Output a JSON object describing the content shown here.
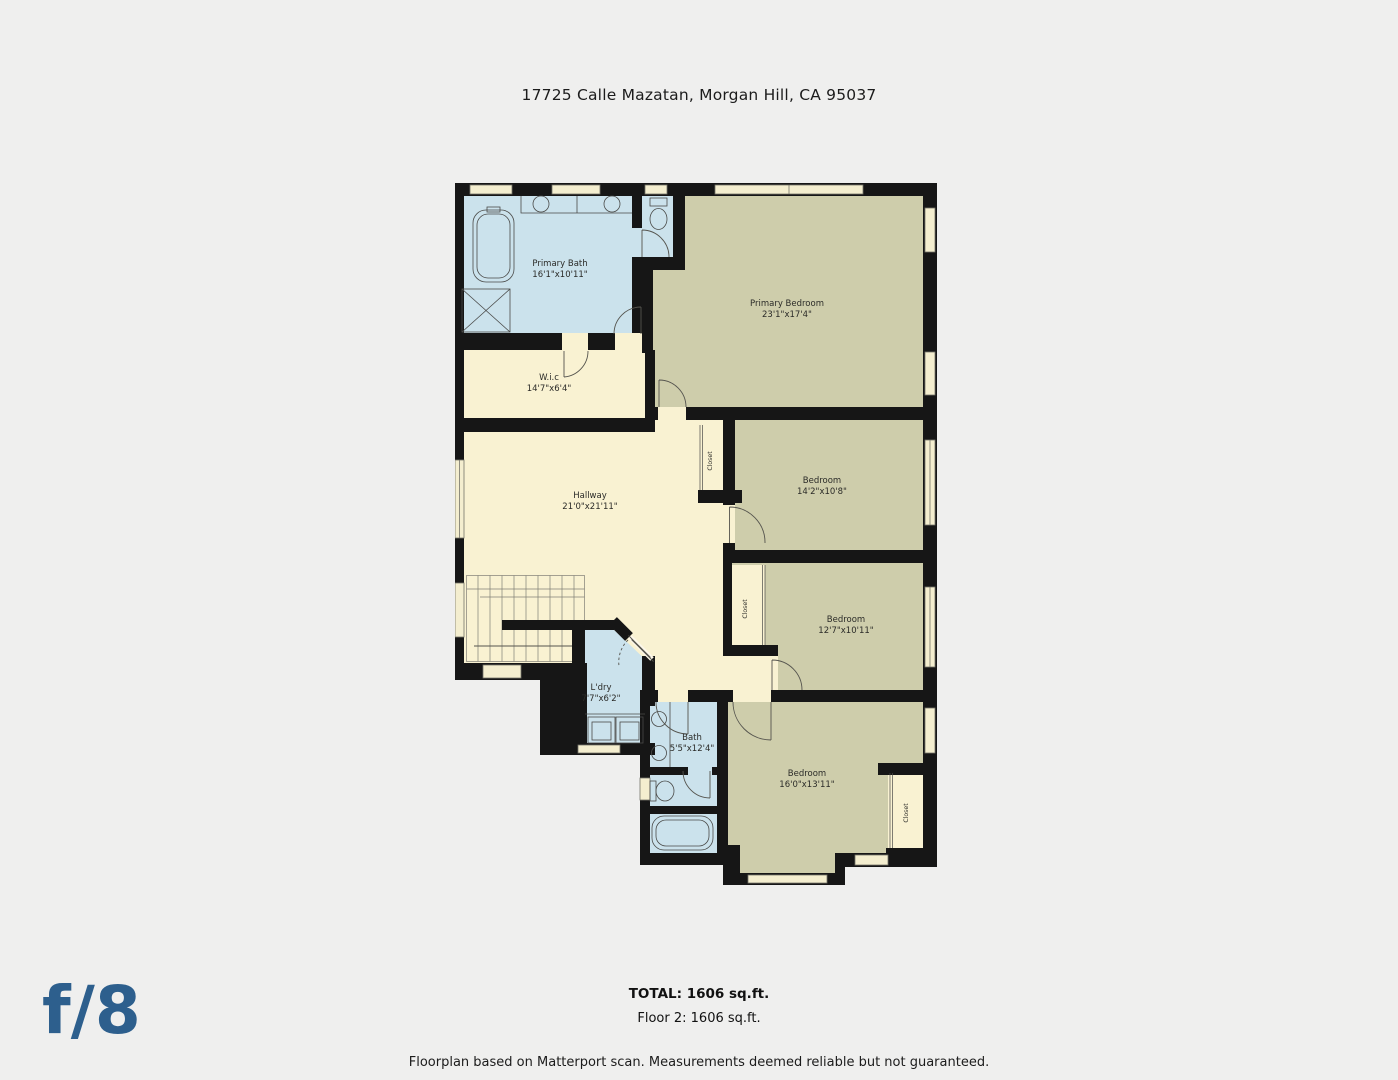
{
  "title": "17725 Calle Mazatan, Morgan Hill, CA 95037",
  "rooms": [
    {
      "name": "Primary Bath",
      "dims": "16'1\"x10'11\""
    },
    {
      "name": "Primary Bedroom",
      "dims": "23'1\"x17'4\""
    },
    {
      "name": "W.i.c",
      "dims": "14'7\"x6'4\""
    },
    {
      "name": "Hallway",
      "dims": "21'0\"x21'11\""
    },
    {
      "name": "Bedroom",
      "dims": "14'2\"x10'8\""
    },
    {
      "name": "Bedroom",
      "dims": "12'7\"x10'11\""
    },
    {
      "name": "L'dry",
      "dims": "7'7\"x6'2\""
    },
    {
      "name": "Bath",
      "dims": "5'5\"x12'4\""
    },
    {
      "name": "Bedroom",
      "dims": "16'0\"x13'11\""
    }
  ],
  "closets": [
    {
      "label": "Closet"
    },
    {
      "label": "Closet"
    },
    {
      "label": "Closet"
    }
  ],
  "summary": {
    "total": "TOTAL: 1606 sq.ft.",
    "floor": "Floor 2: 1606 sq.ft."
  },
  "disclaimer": "Floorplan based on Matterport scan. Measurements deemed reliable but not guaranteed.",
  "logo": "f/8",
  "colors": {
    "wall": "#161616",
    "bedroom_floor": "#cecdab",
    "bath_floor": "#cbe2ec",
    "hall_floor": "#f9f2d2",
    "background": "#efefee",
    "logo_blue": "#2d5f8d"
  }
}
